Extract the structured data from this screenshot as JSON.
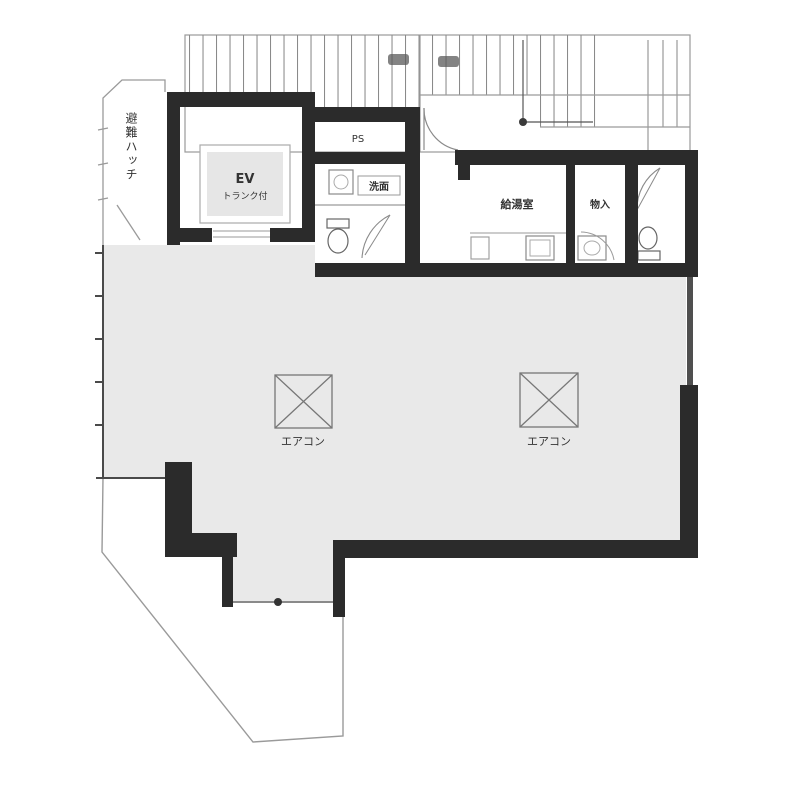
{
  "page": {
    "type": "architectural-floor-plan",
    "background": "#ffffff"
  },
  "colors": {
    "wall": "#2b2b2b",
    "wall_light": "#4f4f4f",
    "room_fill": "#e9e9e9",
    "thin_line": "#9a9a9a",
    "fixture_line": "#8a8a8a",
    "text": "#3a3a3a"
  },
  "labels": {
    "elevator": {
      "line1": "EV",
      "line2": "トランク付"
    },
    "pipe_shaft": "PS",
    "washbasin": "洗面",
    "kitchenette": "給湯室",
    "storage": "物入",
    "evacuation_hatch": "避難ハッチ",
    "ac_left": "エアコン",
    "ac_right": "エアコン"
  },
  "icons": {
    "ac_symbol": "square-with-diagonal-cross",
    "toilet_symbol": "toilet-plan-bowl-and-tank",
    "sink_symbol": "counter-with-sink-basin",
    "door_symbol": "quarter-circle-swing-arc",
    "stair_symbol": "hatched-stair-treads",
    "window_symbol": "thin-double-line-with-center-dot"
  }
}
